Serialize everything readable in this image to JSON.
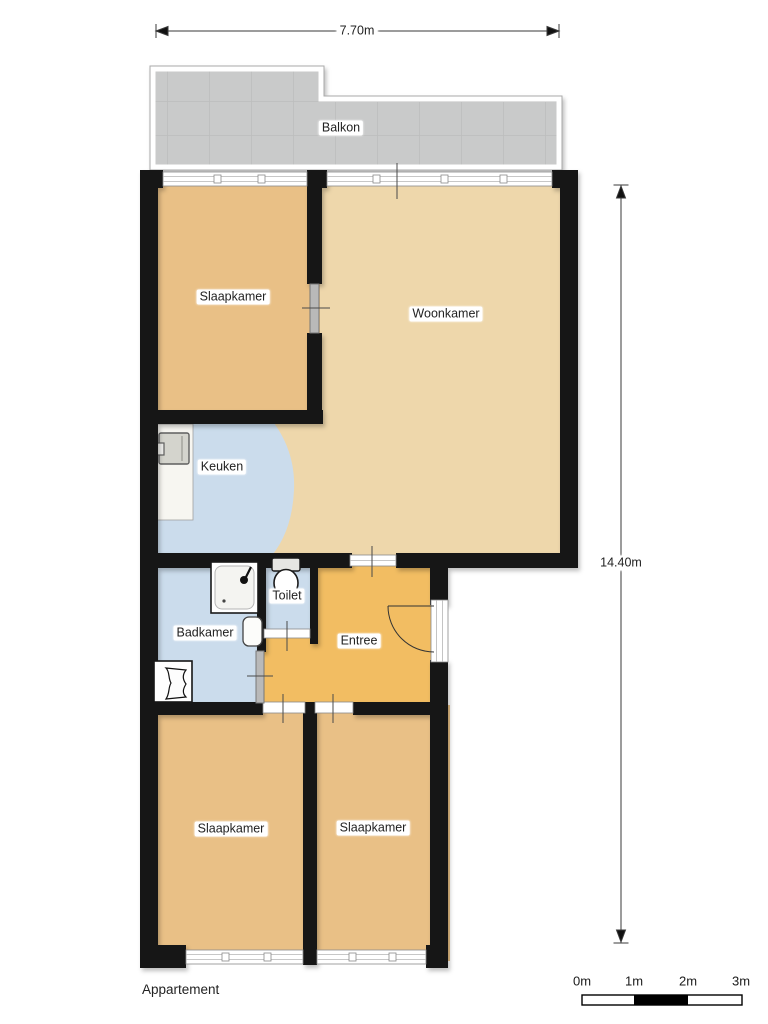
{
  "plan_title": "Appartement",
  "rooms": [
    {
      "name": "balkon",
      "label": "Balkon"
    },
    {
      "name": "slaapkamer-1",
      "label": "Slaapkamer"
    },
    {
      "name": "woonkamer",
      "label": "Woonkamer"
    },
    {
      "name": "keuken",
      "label": "Keuken"
    },
    {
      "name": "badkamer",
      "label": "Badkamer"
    },
    {
      "name": "toilet",
      "label": "Toilet"
    },
    {
      "name": "entree",
      "label": "Entree"
    },
    {
      "name": "slaapkamer-2",
      "label": "Slaapkamer"
    },
    {
      "name": "slaapkamer-3",
      "label": "Slaapkamer"
    }
  ],
  "dimensions": {
    "width_label": "7.70m",
    "height_label": "14.40m"
  },
  "scale_bar": {
    "labels": [
      "0m",
      "1m",
      "2m",
      "3m"
    ]
  },
  "fixtures": [
    "shower",
    "washbasin",
    "laundry-fixture",
    "toilet",
    "kitchen-appliance",
    "entry-door"
  ],
  "colors": {
    "wall": "#141414",
    "bedroom_fill": "#e9c086",
    "living_fill": "#eed7ab",
    "entry_fill": "#f2bd62",
    "wet_room_fill": "#cbdcec",
    "balcony_fill": "#c9caca",
    "background": "#ffffff"
  }
}
